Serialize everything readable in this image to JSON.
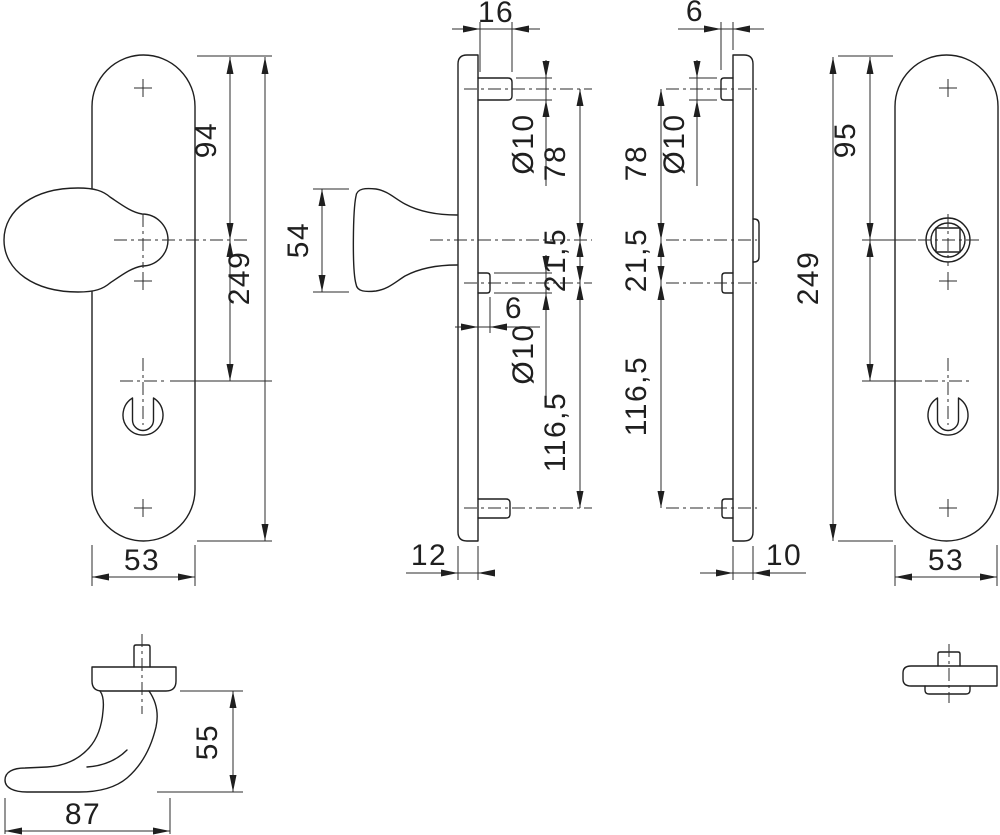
{
  "drawing": {
    "background": "#ffffff",
    "line_color": "#1f1f1f",
    "views": {
      "inside_plate_front": {
        "dims": {
          "top_to_knob_axis": "94",
          "plate_length": "249",
          "plate_width": "53"
        }
      },
      "inside_plate_side": {
        "dims": {
          "spindle_protrusion": "16",
          "top_pin_diameter": "Ø10",
          "knob_height": "54",
          "pin_to_knob_axis": "78",
          "axis_to_mid_pin": "21,5",
          "mid_pin_protrusion": "6",
          "mid_pin_diameter": "Ø10",
          "mid_to_bottom_pin": "116,5",
          "plate_thickness": "12"
        }
      },
      "outside_plate_side": {
        "dims": {
          "pin_protrusion": "6",
          "pin_diameter": "Ø10",
          "pin_to_handle_axis": "78",
          "axis_to_mid_pin": "21,5",
          "mid_to_bottom_pin": "116,5",
          "plate_thickness": "10"
        }
      },
      "outside_plate_front": {
        "dims": {
          "top_to_handle_axis": "95",
          "plate_length": "249",
          "plate_width": "53"
        }
      },
      "lever_handle": {
        "dims": {
          "height": "55",
          "depth": "87"
        }
      }
    }
  }
}
